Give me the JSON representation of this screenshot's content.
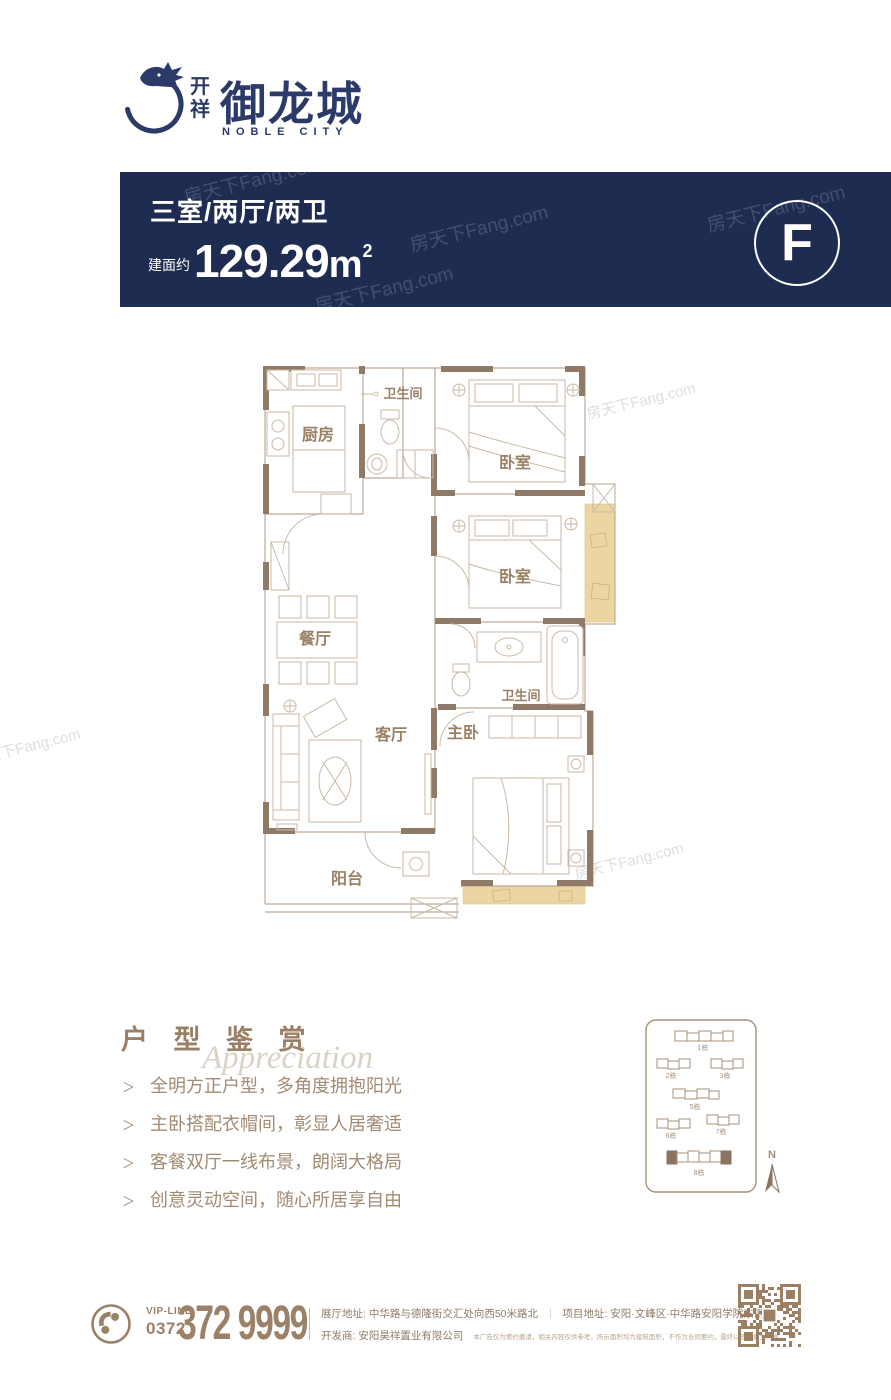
{
  "brand": {
    "prefix_top": "开",
    "prefix_bottom": "祥",
    "name": "御龙城",
    "subtitle": "NOBLE CITY"
  },
  "banner": {
    "layout": "三室/两厅/两卫",
    "area_label": "建面约",
    "area_number": "129.29",
    "area_unit": "m",
    "area_exp": "2",
    "type_letter": "F"
  },
  "watermark": {
    "text": "房天下Fang.com"
  },
  "floorplan": {
    "rooms": {
      "kitchen": "厨房",
      "bath1": "卫生间",
      "bedroom1": "卧室",
      "bedroom2": "卧室",
      "dining": "餐厅",
      "bath2": "卫生间",
      "living": "客厅",
      "master": "主卧",
      "balcony": "阳台"
    }
  },
  "appreciation": {
    "title": "户 型 鉴 赏",
    "script": "Appreciation",
    "marker": "＞",
    "bullets": [
      "全明方正户型，多角度拥抱阳光",
      "主卧搭配衣帽间，彰显人居奢适",
      "客餐双厅一线布景，朗阔大格局",
      "创意灵动空间，随心所居享自由"
    ]
  },
  "sitemap": {
    "labels": {
      "b1": "1栋",
      "b2": "2栋",
      "b3": "3栋",
      "b5": "5栋",
      "b6": "6栋",
      "b7": "7栋",
      "b8": "8栋"
    },
    "highlighted": "8栋",
    "compass_n": "N"
  },
  "footer": {
    "vip_line": "VIP-LINE",
    "area_code": "0372",
    "phone": "372 9999",
    "address_line": "展厅地址: 中华路与德隆街交汇处向西50米路北",
    "address_divider": "｜",
    "project_line": "项目地址: 安阳·文峰区·中华路安阳学院东侧",
    "developer_line": "开发商: 安阳昊祥置业有限公司",
    "disclaimer": "本广告仅为要约邀请，相关内容仅供参考，所示面积均为建筑面积，不作为合同要约，最终以政府批文为准。"
  },
  "colors": {
    "banner_navy": "#1f2c52",
    "logo_navy": "#2b3a68",
    "brown": "#9b8168",
    "wall_brown": "#8e7a66",
    "tan": "#ecd5a0"
  }
}
